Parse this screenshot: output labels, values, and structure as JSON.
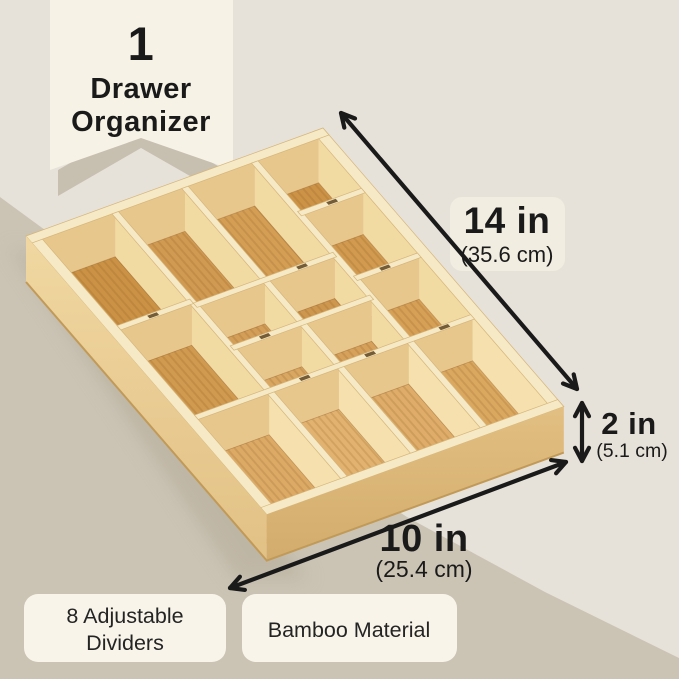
{
  "banner": {
    "count": "1",
    "title_line1": "Drawer",
    "title_line2": "Organizer"
  },
  "dimensions": {
    "length_label": "14 in",
    "length_metric": "(35.6 cm)",
    "height_label": "2 in",
    "height_metric": "(5.1 cm)",
    "width_label": "10 in",
    "width_metric": "(25.4 cm)"
  },
  "badges": {
    "dividers_line1": "8 Adjustable",
    "dividers_line2": "Dividers",
    "material": "Bamboo Material"
  },
  "colors": {
    "background": "#E7E2D9",
    "background_band": "#CBC4B5",
    "banner": "#F6F2E6",
    "banner_shadow": "#C7BFB0",
    "label_pill": "#F1EDE1",
    "badge_pill": "#F8F4E9",
    "text": "#1A1A1A",
    "bamboo_floor": "#D29A57",
    "bamboo_wall": "#F3DCA6",
    "bamboo_rim": "#F6E9C5"
  }
}
